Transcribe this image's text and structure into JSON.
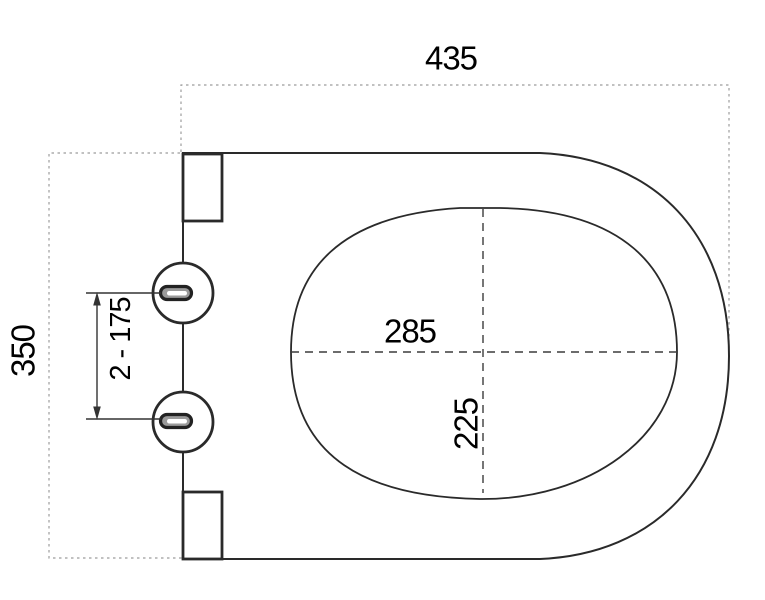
{
  "drawing": {
    "type": "technical-dimension-drawing",
    "subject": "toilet-seat-top-view"
  },
  "labels": {
    "overall_width": "435",
    "overall_depth": "350",
    "hinge_spacing": "2 - 175",
    "inner_width": "285",
    "inner_depth": "225"
  },
  "colors": {
    "outline": "#2a2a2a",
    "guide": "#9c9c9c",
    "centerline": "#3c3c3c",
    "dim": "#333333",
    "slot_fill": "#9a9a9a",
    "slot_stroke": "#222222",
    "text": "#000000",
    "background": "#ffffff"
  }
}
